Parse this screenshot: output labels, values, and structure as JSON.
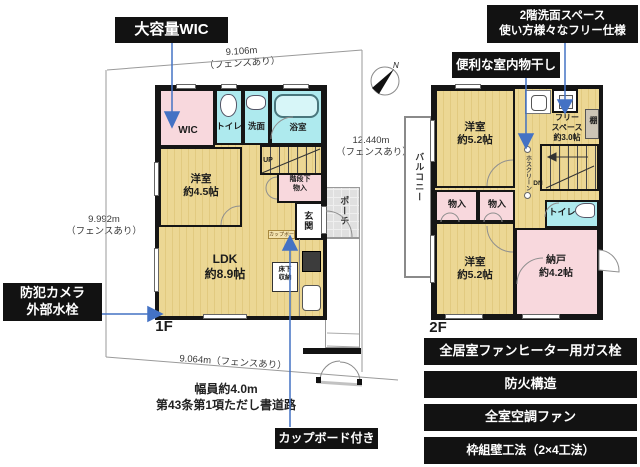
{
  "colors": {
    "accent_blue": "#4472c4",
    "room_tan": "#e8d28e",
    "room_pink": "#f8d8dd",
    "room_cyan": "#aeeaee",
    "callout_bg": "#121212",
    "porch_gray": "#e0e0e0"
  },
  "compass_n": "N",
  "callouts": {
    "large_wic": "大容量WIC",
    "free_space_1": "2階洗面スペース",
    "free_space_2": "使い方様々なフリー仕様",
    "indoor_drying": "便利な室内物干し",
    "security_1": "防犯カメラ",
    "security_2": "外部水栓",
    "cupboard": "カップボード付き"
  },
  "features": [
    "全居室ファンヒーター用ガス栓",
    "防火構造",
    "全室空調ファン",
    "枠組壁工法（2×4工法）"
  ],
  "measurements": {
    "top": "9.106m",
    "top_note": "（フェンスあり）",
    "left": "9.992m",
    "left_note": "（フェンスあり）",
    "right": "12.440m",
    "right_note": "（フェンスあり）",
    "bottom": "9.064m（フェンスあり）",
    "road_1": "幅員約4.0m",
    "road_2": "第43条第1項ただし書道路"
  },
  "floor1": {
    "label": "1F",
    "wic": "WIC",
    "toilet": "トイレ",
    "wash": "洗面",
    "bath": "浴室",
    "up": "UP",
    "bedroom_name": "洋室",
    "bedroom_size": "約4.5帖",
    "understairs_1": "階段下",
    "understairs_2": "物入",
    "entrance": "玄関",
    "porch": "ポーチ",
    "ldk_name": "LDK",
    "ldk_size": "約8.9帖",
    "floor_storage_1": "床下",
    "floor_storage_2": "収納",
    "cupboard_tag": "カップボード"
  },
  "floor2": {
    "label": "2F",
    "bedroom1_name": "洋室",
    "bedroom1_size": "約5.2帖",
    "free_1": "フリー",
    "free_2": "スペース",
    "free_3": "約3.0帖",
    "shelf": "棚",
    "dn": "DN",
    "hosclean": "ホスクリーン",
    "closet1": "物入",
    "closet2": "物入",
    "toilet": "トイレ",
    "bedroom2_name": "洋室",
    "bedroom2_size": "約5.2帖",
    "storage_name": "納戸",
    "storage_size": "約4.2帖",
    "balcony": "バルコニー"
  }
}
